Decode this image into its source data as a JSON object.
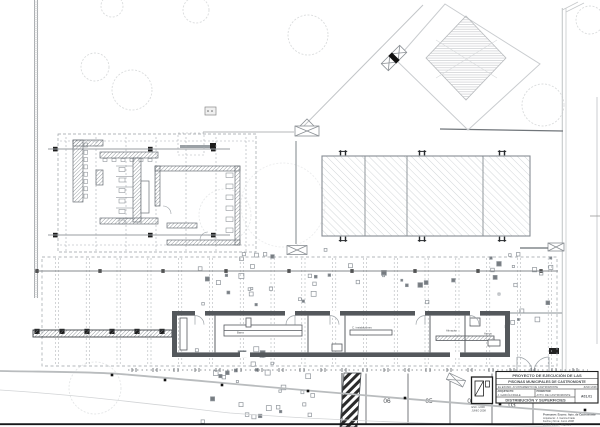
{
  "sheet": {
    "stall_labels": [
      "06",
      "05",
      "04",
      "03"
    ],
    "rooms": [
      "Barra",
      "C. instalaciones",
      "Almacén",
      "Aseos"
    ]
  },
  "title_block": {
    "line1": "PROYECTO DE EJECUCIÓN DE LAS",
    "line2": "PISCINAS MUNICIPALES DE CASTROMONTE",
    "client": "EL EXCMO. AYUNTAMIENTO DE CASTROMONTE",
    "date": "JUNIO 2008",
    "architect_label": "ARQUITECTO:",
    "architect": "J. GARCÍA FRAILE",
    "promoter_label": "PROMOTOR:",
    "promoter": "AYTO. DE CASTROMONTE",
    "sheet_title": "DISTRIBUCIÓN Y SUPERFICIES",
    "sheet_code": "A01.01",
    "scale_note": "ESC. 1/200",
    "date_note": "JUNIO 2008",
    "footnote1": "Promueve: Excmo. Ayto. de Castromonte",
    "footnote2": "Arquitecto: J. García Fraile",
    "footnote3": "Fecha y firma: Junio 2008",
    "footnote4": "Escala 1/200 · Hoja 1/1"
  },
  "colors": {
    "ink": "#1d1d1d",
    "wall_dark": "#54585c",
    "line_mid": "#8a9096",
    "line_light": "#c6cacd"
  }
}
